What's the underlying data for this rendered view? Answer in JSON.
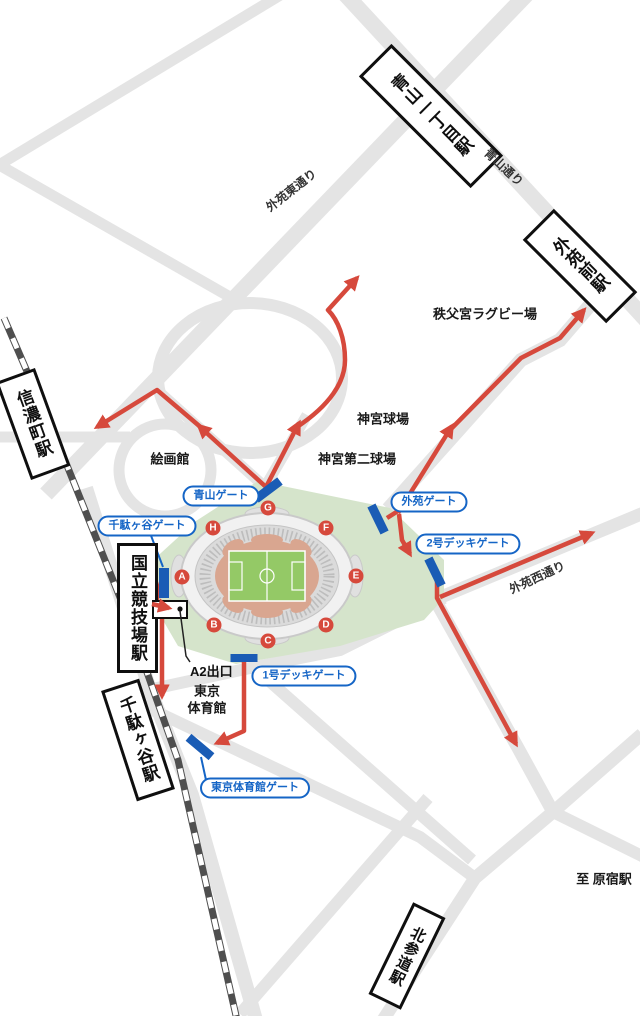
{
  "map": {
    "stations": [
      {
        "name": "青山一丁目駅"
      },
      {
        "name": "外苑前駅"
      },
      {
        "name": "信濃町駅"
      },
      {
        "name": "国立競技場駅"
      },
      {
        "name": "千駄ヶ谷駅"
      },
      {
        "name": "北参道駅"
      }
    ],
    "roads": [
      {
        "name": "外苑東通り"
      },
      {
        "name": "青山通り"
      },
      {
        "name": "外苑西通り"
      }
    ],
    "places": [
      {
        "name": "秩父宮ラグビー場"
      },
      {
        "name": "神宮球場"
      },
      {
        "name": "神宮第二球場"
      },
      {
        "name": "絵画館"
      },
      {
        "name_line1": "東京",
        "name_line2": "体育館"
      }
    ],
    "venue_gates": [
      {
        "name": "青山ゲート"
      },
      {
        "name": "千駄ヶ谷ゲート"
      },
      {
        "name": "外苑ゲート"
      },
      {
        "name": "2号デッキゲート"
      },
      {
        "name": "1号デッキゲート"
      },
      {
        "name": "東京体育館ゲート"
      }
    ],
    "stadium_gate_letters": [
      "A",
      "B",
      "C",
      "D",
      "E",
      "F",
      "G",
      "H"
    ],
    "labels": {
      "exit": "A2出口",
      "to_harajuku": "至 原宿駅"
    },
    "colors": {
      "route_red": "#d6493c",
      "gate_bar_blue": "#1a5cb5",
      "pill_blue": "#1565c6",
      "road_gray": "#e4e4e4",
      "park_green": "#d5e4cb",
      "track_salmon": "#d9a690",
      "pitch_green": "#94c966",
      "railway_dark": "#4f4f4f"
    }
  }
}
